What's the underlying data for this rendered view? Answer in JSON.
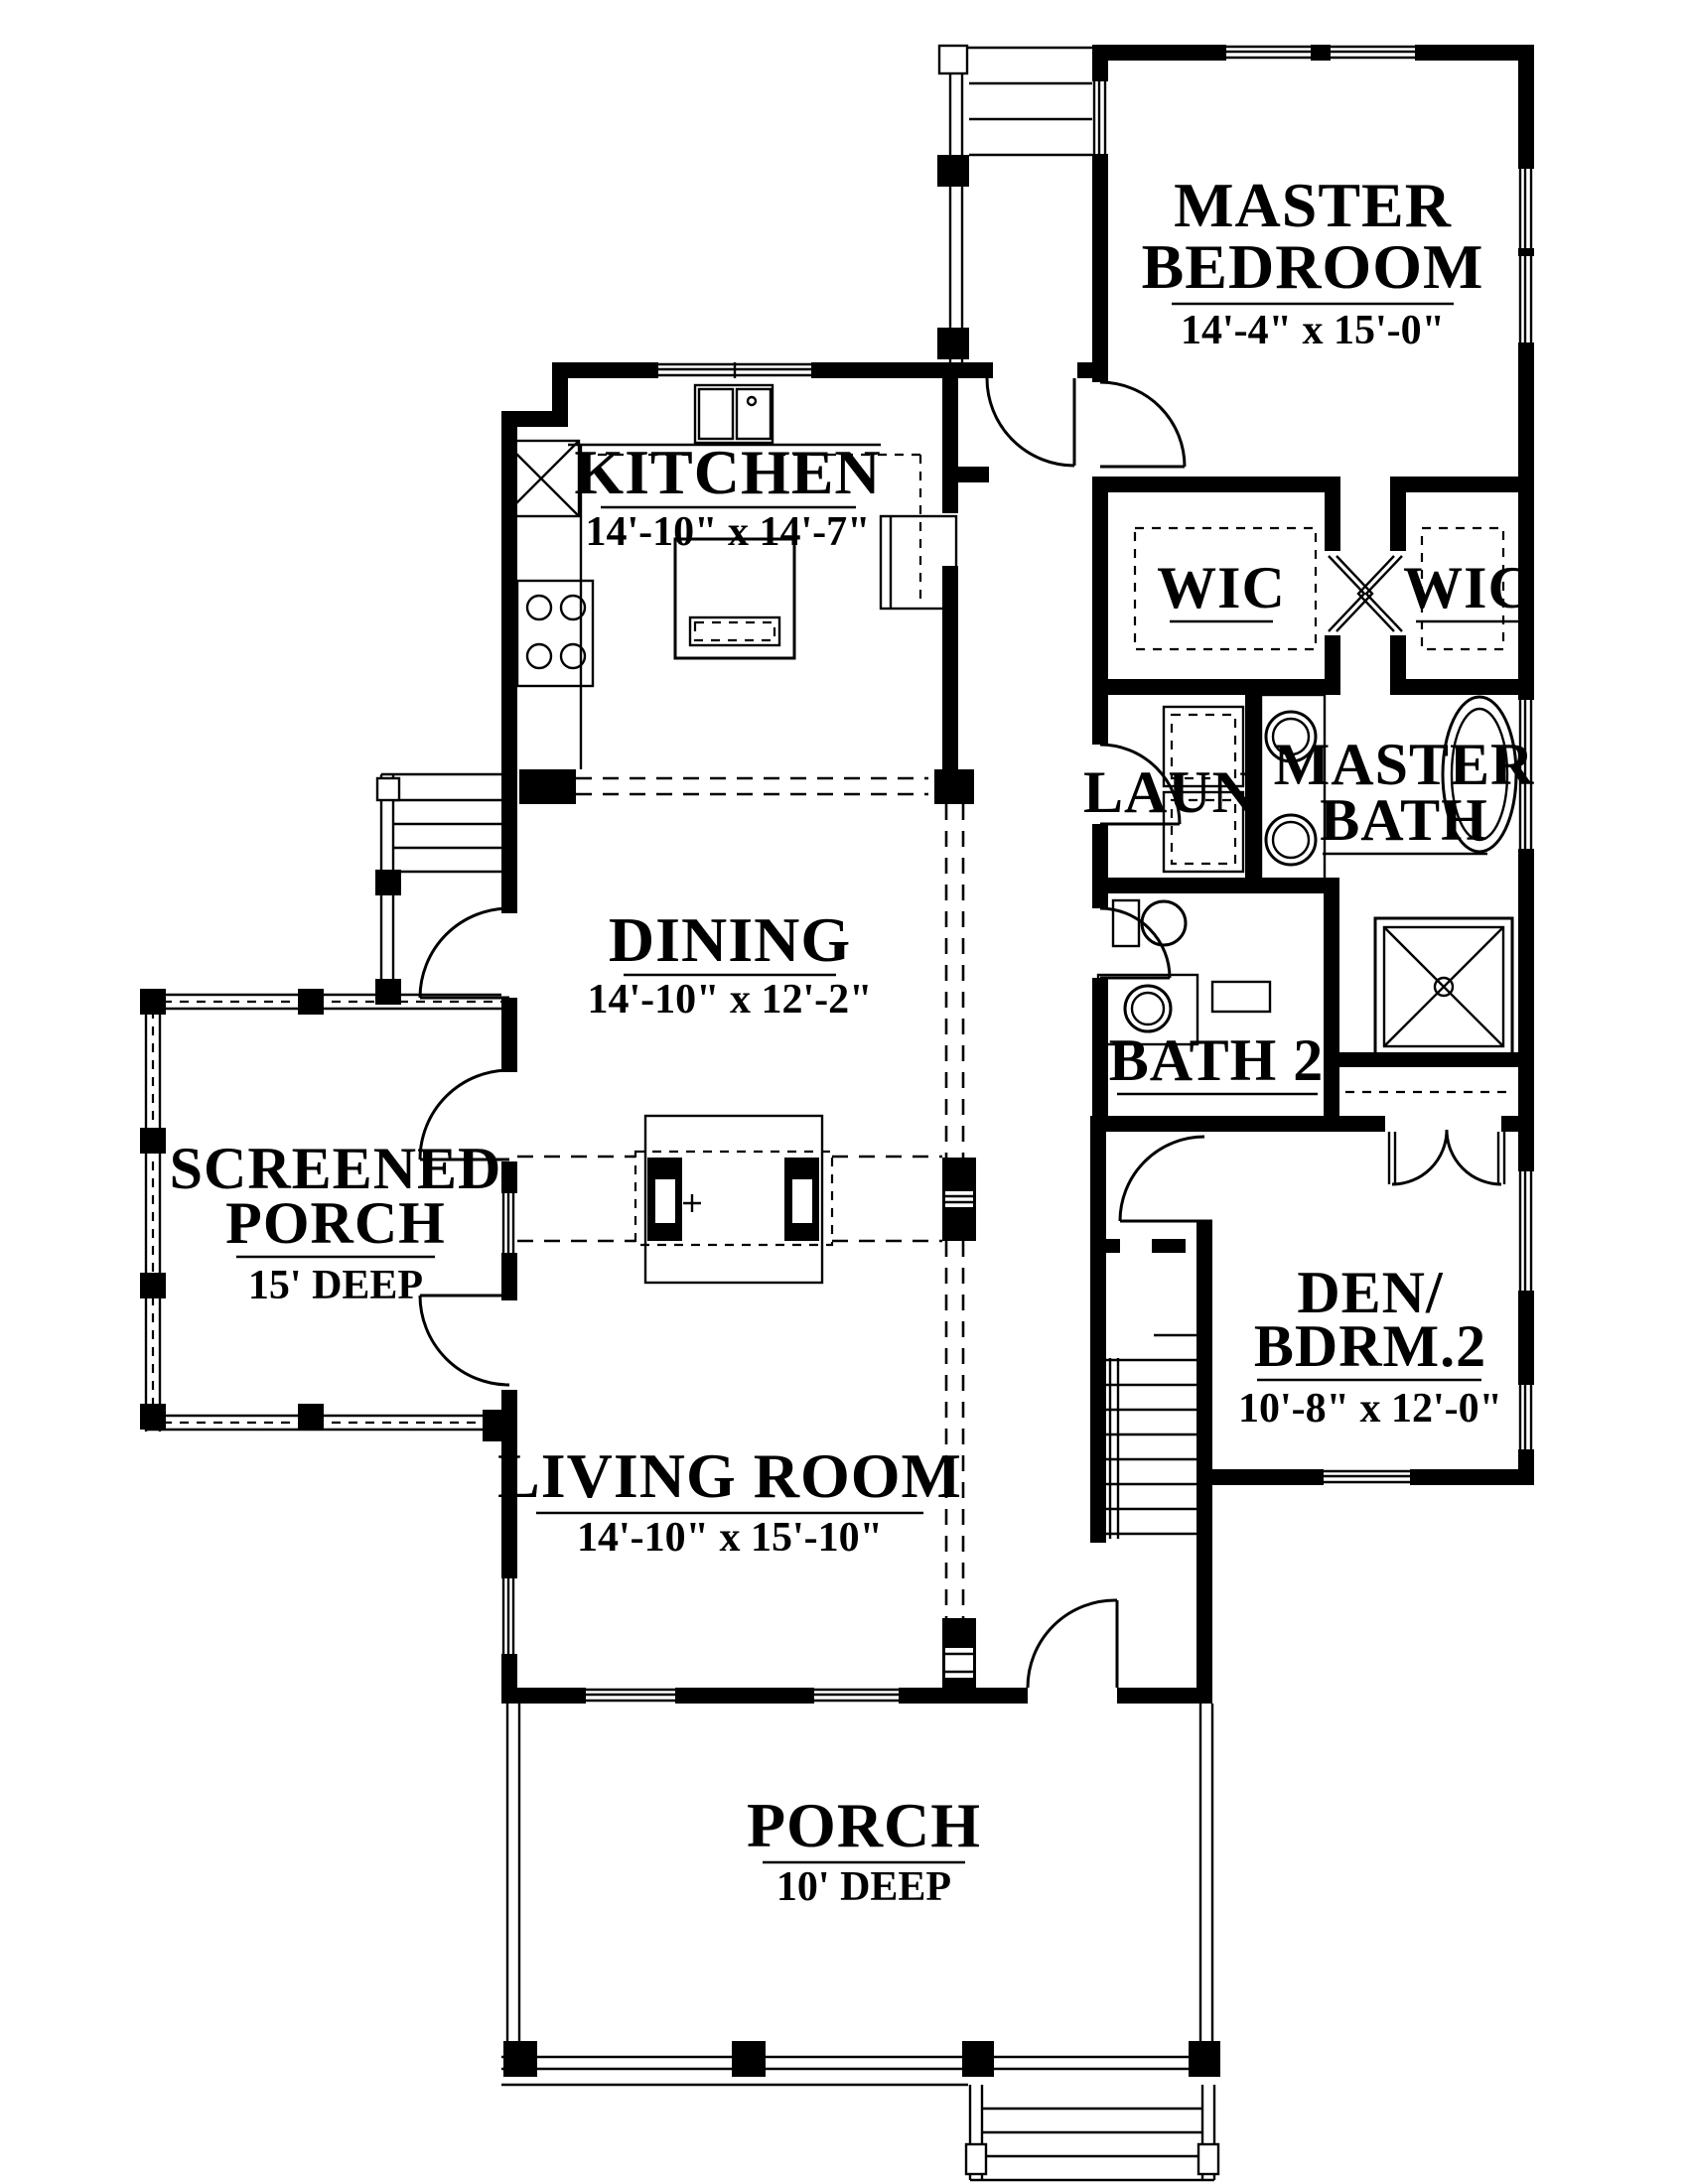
{
  "plan": {
    "title": "single-story house floor plan",
    "colors": {
      "ink": "#000000",
      "paper": "#ffffff"
    },
    "rooms": {
      "master_bedroom": {
        "line1": "MASTER",
        "line2": "BEDROOM",
        "dims": "14'-4\" x 15'-0\""
      },
      "kitchen": {
        "name": "KITCHEN",
        "dims": "14'-10\" x 14'-7\""
      },
      "wic_left": {
        "name": "WIC"
      },
      "wic_right": {
        "name": "WIC"
      },
      "laundry": {
        "name": "LAUN"
      },
      "master_bath": {
        "line1": "MASTER",
        "line2": "BATH"
      },
      "dining": {
        "name": "DINING",
        "dims": "14'-10\" x 12'-2\""
      },
      "bath2": {
        "name": "BATH 2"
      },
      "screened_porch": {
        "line1": "SCREENED",
        "line2": "PORCH",
        "depth": "15' DEEP"
      },
      "den": {
        "line1": "DEN/",
        "line2": "BDRM.2",
        "dims": "10'-8\" x 12'-0\""
      },
      "living_room": {
        "name": "LIVING ROOM",
        "dims": "14'-10\" x 15'-10\""
      },
      "porch": {
        "name": "PORCH",
        "depth": "10' DEEP"
      }
    }
  }
}
